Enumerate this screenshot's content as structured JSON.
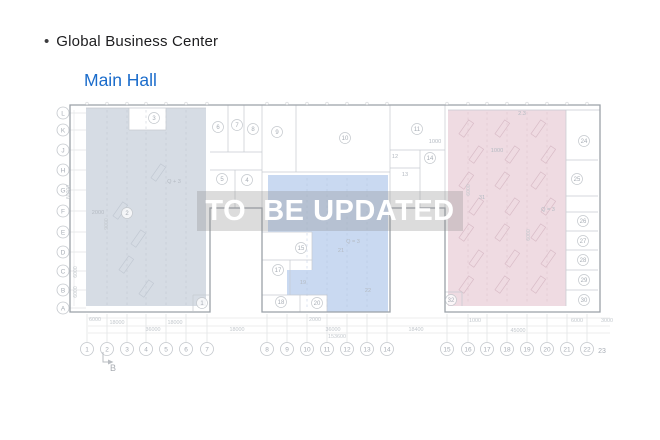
{
  "header": {
    "bullet": "•",
    "title": "Global Business Center",
    "subtitle": "Main Hall"
  },
  "watermark": {
    "text": "TO  BE UPDATED"
  },
  "plan": {
    "colors": {
      "left_zone_fill": "#d4dae3",
      "middle_zone_fill": "#c6d7f0",
      "right_zone_fill": "#eed9e0",
      "outer_wall": "#9ba1a8",
      "inner_wall": "#c6cad0",
      "bubble_stroke": "#c4c8cd",
      "bubble_text": "#a7adb5",
      "dim_text": "#c3c8cd",
      "zone_label_text": "#b4bac2",
      "leader_line": "#e1e3e5"
    },
    "row_labels": [
      [
        "L",
        113
      ],
      [
        "K",
        130
      ],
      [
        "J",
        150
      ],
      [
        "H",
        170
      ],
      [
        "G",
        190
      ],
      [
        "F",
        211
      ],
      [
        "E",
        232
      ],
      [
        "D",
        252
      ],
      [
        "C",
        271
      ],
      [
        "B",
        290
      ],
      [
        "A",
        308
      ]
    ],
    "col_labels": [
      [
        "1",
        87
      ],
      [
        "2",
        107
      ],
      [
        "3",
        127
      ],
      [
        "4",
        146
      ],
      [
        "5",
        166
      ],
      [
        "6",
        186
      ],
      [
        "7",
        207
      ],
      [
        "8",
        267
      ],
      [
        "9",
        287
      ],
      [
        "10",
        307
      ],
      [
        "11",
        327
      ],
      [
        "12",
        347
      ],
      [
        "13",
        367
      ],
      [
        "14",
        387
      ],
      [
        "15",
        447
      ],
      [
        "16",
        468
      ],
      [
        "17",
        487
      ],
      [
        "18",
        507
      ],
      [
        "19",
        527
      ],
      [
        "20",
        547
      ],
      [
        "21",
        567
      ],
      [
        "22",
        587
      ]
    ],
    "col_label_plain": {
      "t": "23",
      "x": 602,
      "y": 353
    },
    "rooms": [
      [
        "1",
        202,
        303
      ],
      [
        "2",
        127,
        213
      ],
      [
        "3",
        154,
        118
      ],
      [
        "4",
        247,
        180
      ],
      [
        "5",
        222,
        179
      ],
      [
        "6",
        218,
        127
      ],
      [
        "7",
        237,
        125
      ],
      [
        "8",
        253,
        129
      ],
      [
        "9",
        277,
        132
      ],
      [
        "10",
        345,
        138
      ],
      [
        "11",
        417,
        129
      ],
      [
        "14",
        430,
        158
      ],
      [
        "15",
        301,
        248
      ],
      [
        "17",
        278,
        270
      ],
      [
        "18",
        281,
        302
      ],
      [
        "20",
        317,
        303
      ],
      [
        "24",
        584,
        141
      ],
      [
        "25",
        577,
        179
      ],
      [
        "26",
        583,
        221
      ],
      [
        "27",
        583,
        241
      ],
      [
        "28",
        583,
        260
      ],
      [
        "29",
        584,
        280
      ],
      [
        "30",
        584,
        300
      ],
      [
        "32",
        451,
        300
      ]
    ],
    "labels": [
      [
        "12",
        395,
        158
      ],
      [
        "13",
        405,
        176
      ],
      [
        "19",
        303,
        284
      ],
      [
        "21",
        341,
        252
      ],
      [
        "22",
        368,
        292
      ],
      [
        "31",
        482,
        199
      ],
      [
        "Q + 3",
        174,
        183
      ],
      [
        "Q = 3",
        353,
        243
      ],
      [
        "Q = 3",
        548,
        211
      ],
      [
        "2.3",
        522,
        115
      ],
      [
        "2000",
        98,
        214
      ],
      [
        "1000",
        435,
        143
      ],
      [
        "1000",
        497,
        152
      ]
    ],
    "vlabels": [
      [
        "60000",
        70,
        192
      ],
      [
        "6000",
        77,
        272
      ],
      [
        "6000",
        77,
        292
      ],
      [
        "9000",
        108,
        224
      ],
      [
        "6000",
        470,
        190
      ],
      [
        "6000",
        530,
        235
      ]
    ],
    "dims": [
      [
        "6000",
        95,
        321
      ],
      [
        "18000",
        117,
        324
      ],
      [
        "18000",
        175,
        324
      ],
      [
        "2000",
        315,
        321
      ],
      [
        "1000",
        475,
        322
      ],
      [
        "6000",
        577,
        322
      ],
      [
        "3000",
        607,
        322
      ],
      [
        "36000",
        153,
        331
      ],
      [
        "18000",
        237,
        331
      ],
      [
        "36000",
        333,
        331
      ],
      [
        "18400",
        416,
        331
      ],
      [
        "45000",
        518,
        332
      ],
      [
        "153600",
        337,
        338
      ]
    ],
    "section_marker": {
      "t": "B",
      "x": 113,
      "y": 371
    }
  }
}
